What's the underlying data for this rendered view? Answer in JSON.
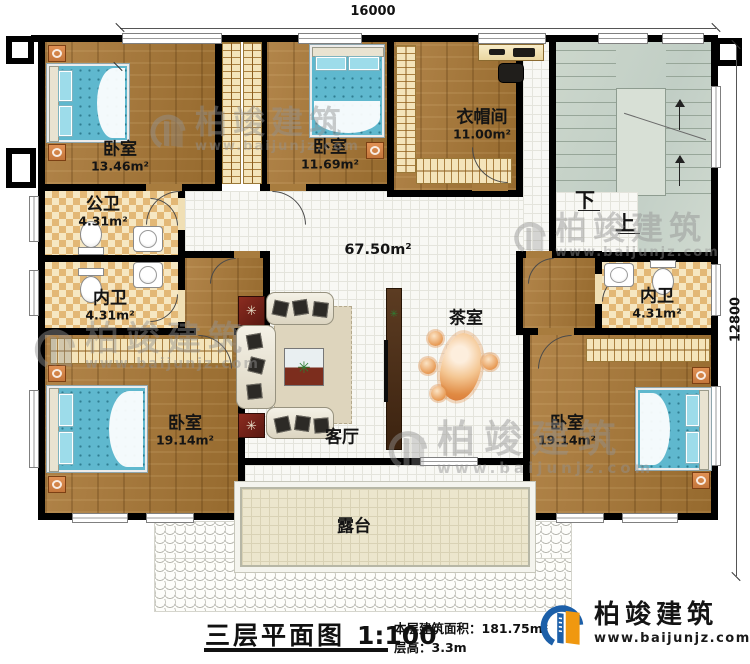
{
  "dimensions": {
    "top": "16000",
    "right": "12800"
  },
  "rooms": [
    {
      "id": "bedroom-top-left",
      "name": "卧室",
      "area": "13.46m²"
    },
    {
      "id": "bedroom-top-middle",
      "name": "卧室",
      "area": "11.69m²"
    },
    {
      "id": "cloakroom",
      "name": "衣帽间",
      "area": "11.00m²"
    },
    {
      "id": "public-bathroom",
      "name": "公卫",
      "area": "4.31m²"
    },
    {
      "id": "inner-bathroom-left",
      "name": "内卫",
      "area": "4.31m²"
    },
    {
      "id": "inner-bathroom-right",
      "name": "内卫",
      "area": "4.31m²"
    },
    {
      "id": "bedroom-bottom-left",
      "name": "卧室",
      "area": "19.14m²"
    },
    {
      "id": "bedroom-bottom-right",
      "name": "卧室",
      "area": "19.14m²"
    }
  ],
  "hall": {
    "area": "67.50m²",
    "tea_room": "茶室",
    "living_room": "客厅",
    "terrace": "露台"
  },
  "stairs": {
    "down": "下",
    "up": "上"
  },
  "titleblock": {
    "title": "三层平面图",
    "scale": "1:100",
    "area_label": "本层建筑面积：",
    "area_value": "181.75m²",
    "height_label": "层高：",
    "height_value": "3.3m"
  },
  "brand": {
    "name": "柏竣建筑",
    "url": "www.baijunjz.com"
  },
  "watermark": {
    "name": "柏竣建筑",
    "url": "www.baijunjz.com"
  },
  "colors": {
    "wall": "#000000",
    "wood_floor": "#a87c3e",
    "hall_tile": "#f8f8f4",
    "bath_tile": "#e3b876",
    "stair": "#ccd7cc",
    "bed": "#5fb8ce",
    "terrace": "#ece6cd",
    "brand_blue": "#1c5fa8",
    "brand_orange": "#f0980f",
    "watermark_gray": "#929292"
  }
}
